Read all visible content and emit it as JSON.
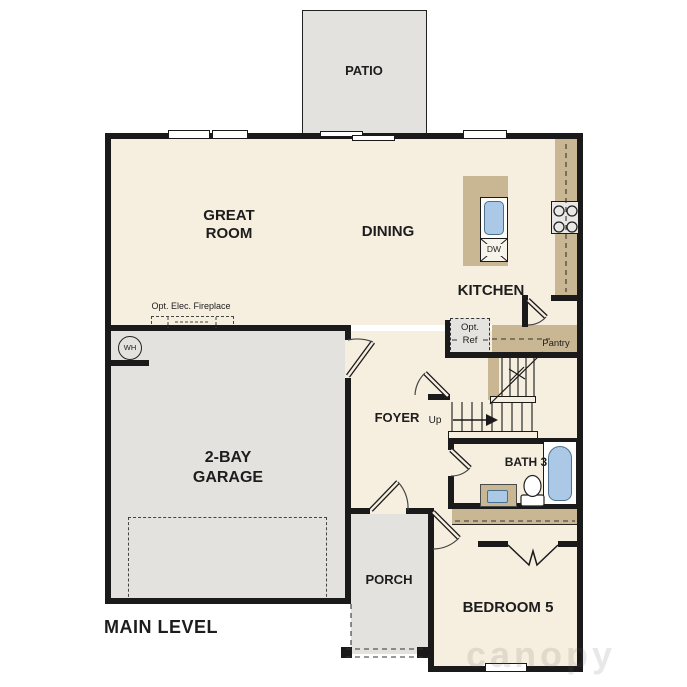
{
  "plan": {
    "level_label": "MAIN LEVEL",
    "watermark": "canopy",
    "rooms": {
      "patio": "PATIO",
      "great_room": "GREAT ROOM",
      "dining": "DINING",
      "kitchen": "KITCHEN",
      "garage": "2-BAY GARAGE",
      "foyer": "FOYER",
      "pantry": "Pantry",
      "bath3": "BATH 3",
      "bedroom5": "BEDROOM 5",
      "porch": "PORCH"
    },
    "annotations": {
      "fireplace": "Opt. Elec. Fireplace",
      "water_heater": "WH",
      "opt_ref_line1": "Opt.",
      "opt_ref_line2": "Ref",
      "dishwasher": "DW",
      "stairs_up": "Up"
    },
    "colors": {
      "wall": "#1a1a1a",
      "floor": "#f6eedf",
      "exterior": "#e3e2df",
      "counter": "#c9b693",
      "fixture_blue": "#abc9e6"
    }
  }
}
